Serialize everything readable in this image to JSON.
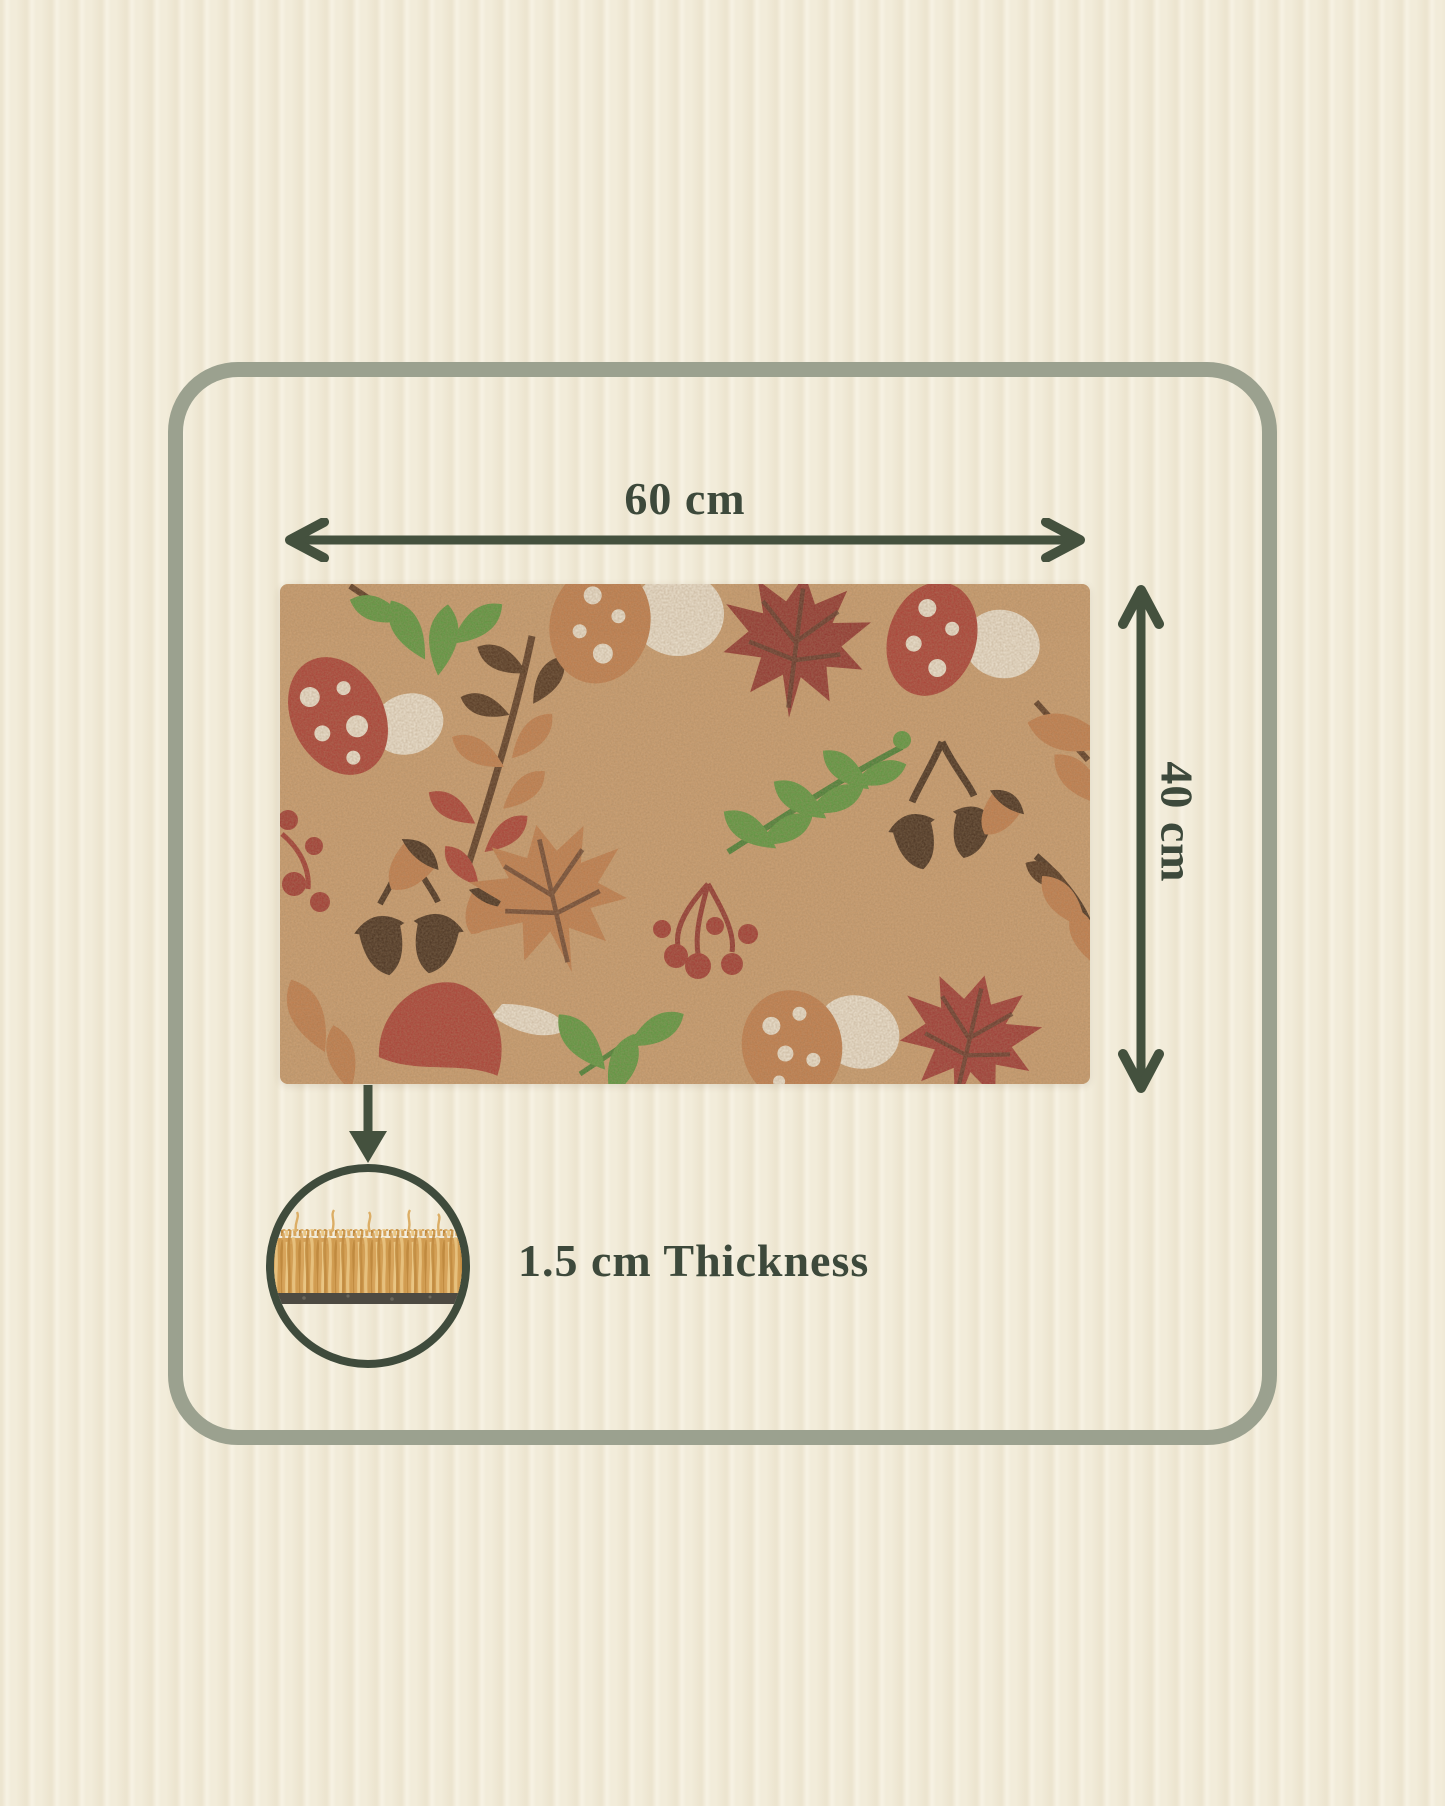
{
  "canvas": {
    "background_color": "#f2ecda",
    "texture": "ribbed-fabric"
  },
  "frame": {
    "border_color": "#9ba18f"
  },
  "labels": {
    "width": "60 cm",
    "height": "40 cm",
    "thickness": "1.5 cm Thickness"
  },
  "label_color": "#3d493b",
  "arrow_color": "#44513e",
  "doormat": {
    "base_color": "#c89a6b",
    "motif_colors": {
      "red": "#a8392f",
      "dark_red": "#8e2e29",
      "orange": "#bf7a48",
      "dark_brown": "#3f2817",
      "brown": "#54331d",
      "green": "#55953a",
      "cream": "#ece2d0",
      "berry": "#9e332c"
    },
    "motifs": [
      "red-spotted-mushroom-top-left",
      "green-leaf-cluster",
      "rowan-branch",
      "orange-spotted-mushroom-top",
      "dark-red-maple-leaf",
      "red-spotted-mushroom-top-right",
      "acorns",
      "green-leaf-branch",
      "red-berries",
      "orange-maple-leaf",
      "berry-cluster",
      "red-bell-mushroom",
      "green-leaves",
      "orange-spotted-mushroom-bottom",
      "red-maple-leaf-bottom-right",
      "orange-leaves"
    ]
  },
  "cross_section": {
    "fiber_color": "#d8a55c",
    "backing_color": "#4d4a42"
  }
}
